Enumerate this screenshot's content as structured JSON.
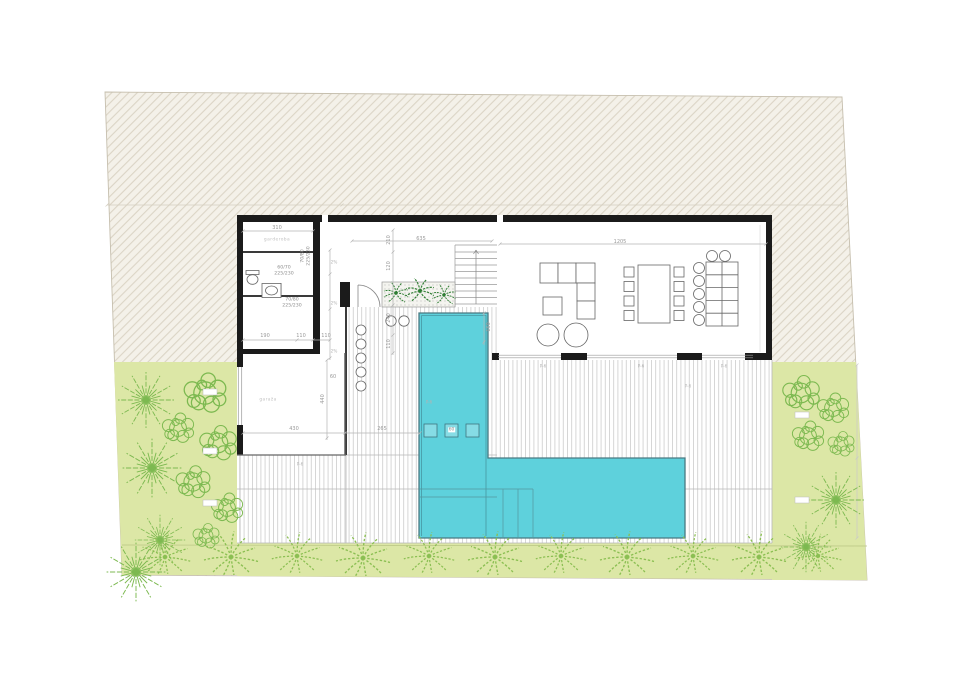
{
  "plan": {
    "kind": "villa ground floor site plan",
    "colors": {
      "site_hatch_bg": "#f4f1e9",
      "site_hatch_line": "#d9d2c2",
      "garden_green": "#dce7a6",
      "tree_stroke": "#7cb950",
      "fern_stroke": "#8bbf52",
      "palm_stroke": "#2e7d32",
      "pool_fill": "#5ed1dc",
      "pool_edge": "#4a7a82",
      "wall_black": "#1b1b1b",
      "deck_line": "#cdcdcd",
      "dim_color": "#9a9a9a"
    },
    "labels": {
      "dim_310": "310",
      "dim_635": "635",
      "dim_1205": "1205",
      "door_6070": "60/70",
      "door_7080": "70/80",
      "door_height": "225/230",
      "dim_190": "190",
      "dim_110": "110",
      "dim_210": "210",
      "dim_120": "120",
      "dim_240": "240",
      "dim_430": "430",
      "dim_440": "440",
      "dim_265": "265",
      "dim_150": "150",
      "dim_60": "60",
      "slope": "2%",
      "paving_marker": "P-6",
      "pool_fitting_tag": "60",
      "room_wardrobe": "garderoba",
      "room_garage": "garaža"
    }
  }
}
